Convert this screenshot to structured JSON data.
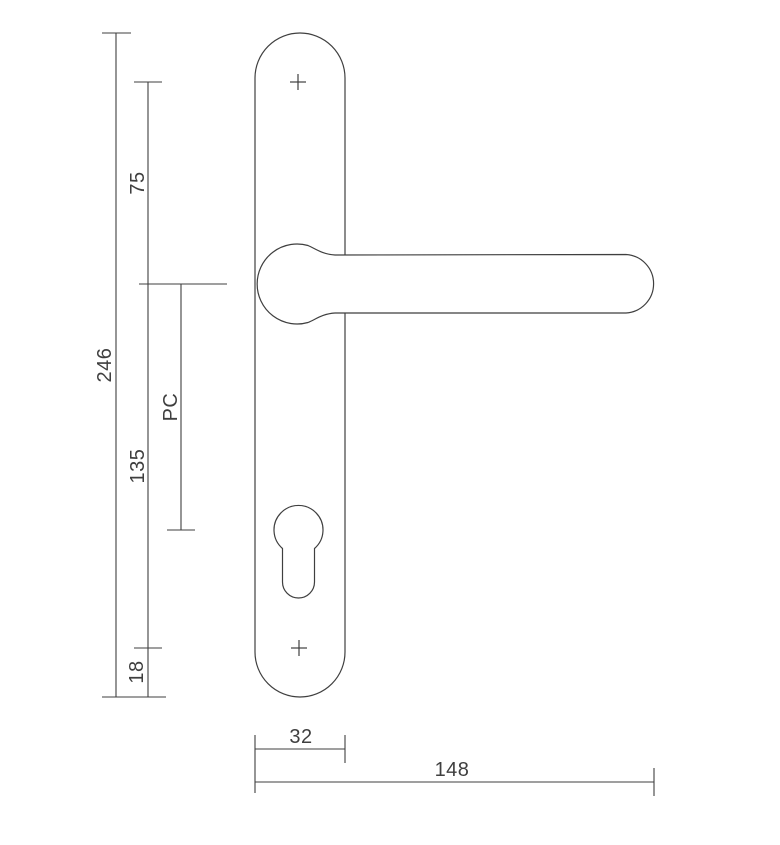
{
  "drawing": {
    "type": "technical-drawing-door-handle-backplate",
    "background_color": "#ffffff",
    "line_color": "#3f3f3f",
    "dimensions": {
      "overall_height": "246",
      "top_screw_to_handle_center": "75",
      "handle_center_to_bottom_screw": "135",
      "cylinder_distance_label": "PC",
      "bottom_screw_to_edge": "18",
      "plate_width": "32",
      "handle_length": "148"
    }
  }
}
